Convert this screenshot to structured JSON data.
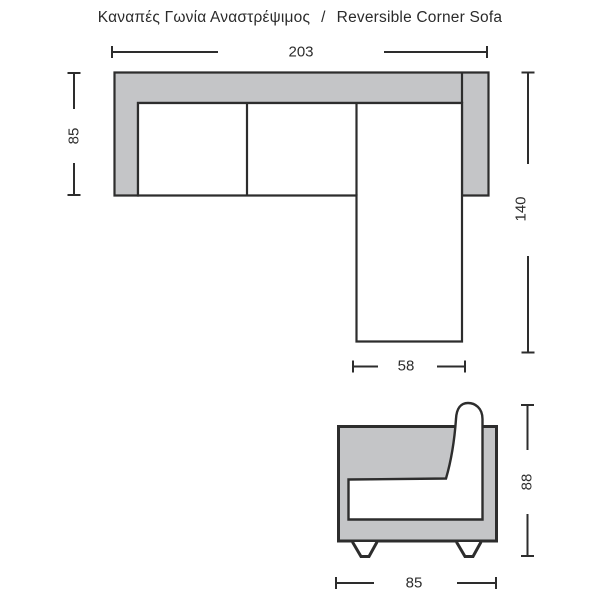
{
  "title": {
    "el": "Καναπές Γωνία Αναστρέψιμος",
    "separator": "/",
    "en": "Reversible Corner Sofa"
  },
  "top_view": {
    "dim_width": "203",
    "dim_depth": "85",
    "dim_length": "140",
    "dim_chaise_width": "58"
  },
  "front_view": {
    "dim_height": "88",
    "dim_width": "85"
  },
  "colors": {
    "sofa_fill": "#c4c5c7",
    "cushion_fill": "#ffffff",
    "line": "#2d2d2d",
    "text": "#2b2b2b",
    "background": "#ffffff"
  }
}
